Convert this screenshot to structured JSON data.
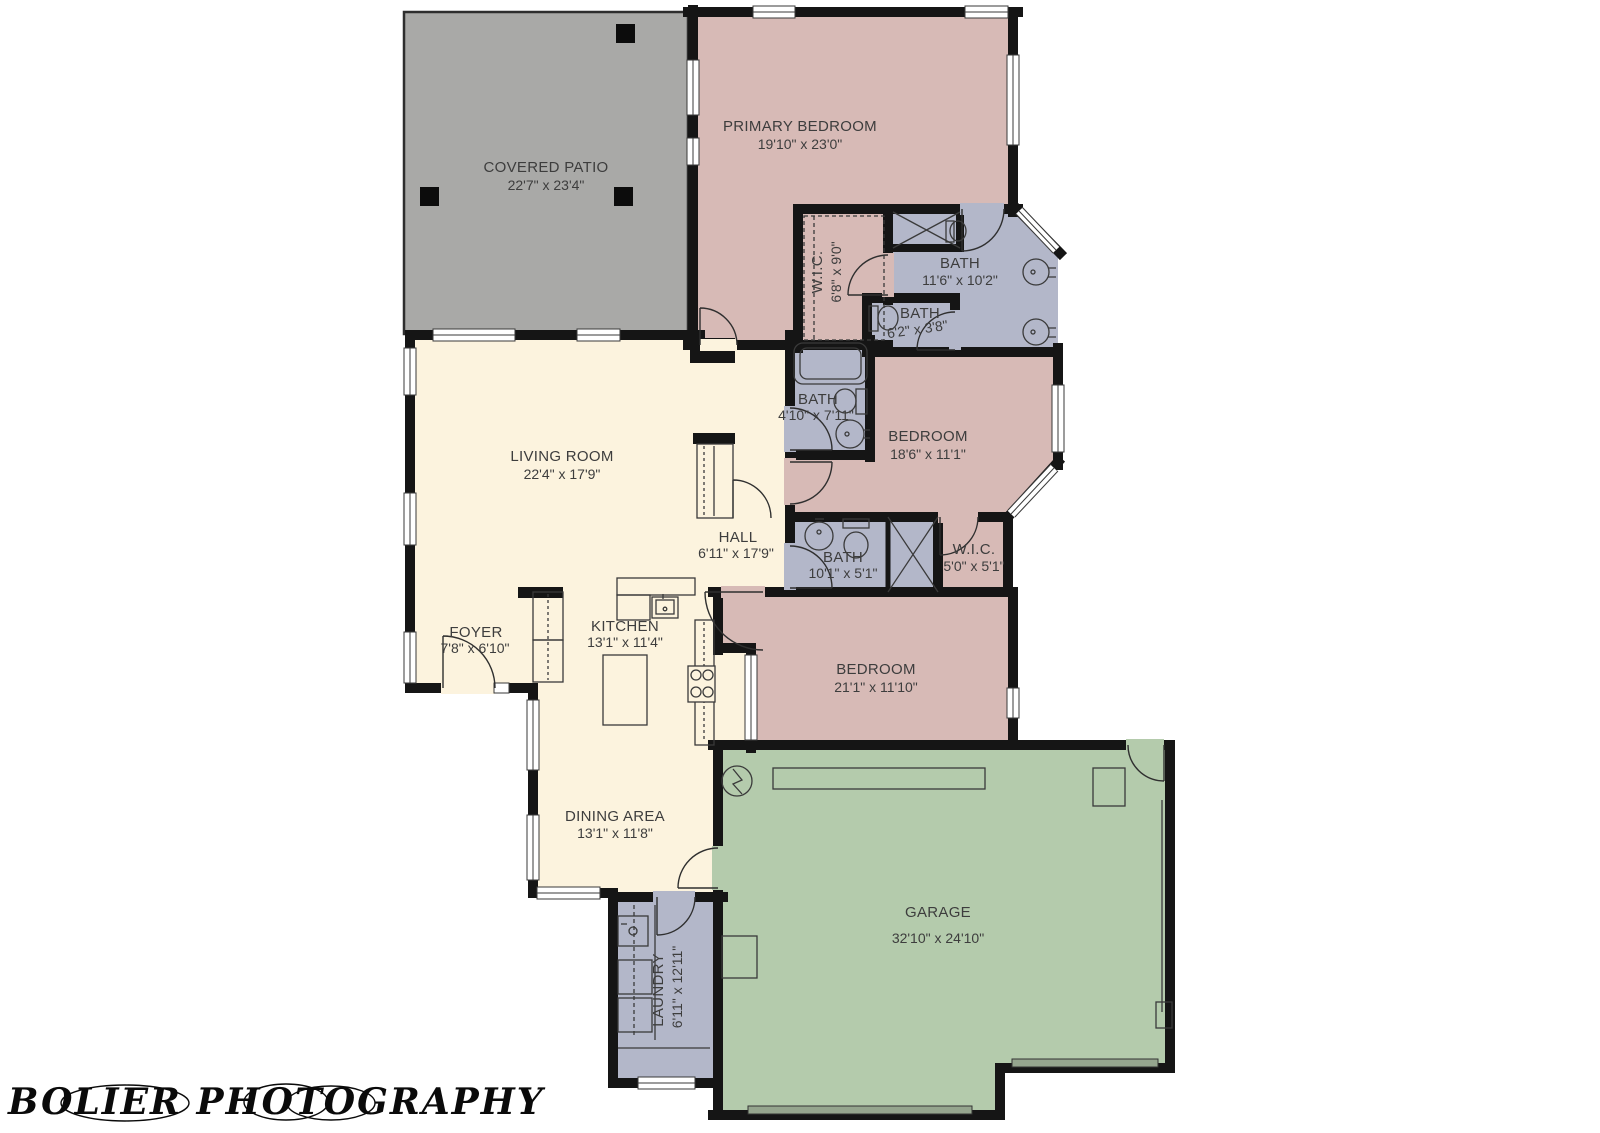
{
  "watermark": {
    "text": "BOLIER PHOTOGRAPHY"
  },
  "colors": {
    "patio": "#a9a9a7",
    "floor_cream": "#fcf3de",
    "room_pink": "#d7bab6",
    "room_blue": "#b3b7c9",
    "garage_green": "#b4cbac",
    "wall": "#151515"
  },
  "rooms": {
    "covered_patio": {
      "name": "COVERED PATIO",
      "dims": "22'7\" x 23'4\""
    },
    "primary_bedroom": {
      "name": "PRIMARY BEDROOM",
      "dims": "19'10\" x 23'0\""
    },
    "wic_primary": {
      "name": "W.I.C.",
      "dims": "6'8\" x 9'0\""
    },
    "bath_primary": {
      "name": "BATH",
      "dims": "11'6\" x 10'2\""
    },
    "bath_small": {
      "name": "BATH",
      "dims": "6'2\" x 3'8\""
    },
    "bath_hall": {
      "name": "BATH",
      "dims": "4'10\" x 7'11\""
    },
    "bedroom_mid": {
      "name": "BEDROOM",
      "dims": "18'6\" x 11'1\""
    },
    "hall": {
      "name": "HALL",
      "dims": "6'11\" x 17'9\""
    },
    "bath_shared": {
      "name": "BATH",
      "dims": "10'1\" x 5'1\""
    },
    "wic_small": {
      "name": "W.I.C.",
      "dims": "5'0\" x 5'1\""
    },
    "living_room": {
      "name": "LIVING ROOM",
      "dims": "22'4\" x 17'9\""
    },
    "foyer": {
      "name": "FOYER",
      "dims": "7'8\" x 6'10\""
    },
    "kitchen": {
      "name": "KITCHEN",
      "dims": "13'1\" x 11'4\""
    },
    "dining": {
      "name": "DINING AREA",
      "dims": "13'1\" x 11'8\""
    },
    "bedroom_front": {
      "name": "BEDROOM",
      "dims": "21'1\" x 11'10\""
    },
    "garage": {
      "name": "GARAGE",
      "dims": "32'10\" x 24'10\""
    },
    "laundry": {
      "name": "LAUNDRY",
      "dims": "6'11\" x 12'11\""
    }
  }
}
